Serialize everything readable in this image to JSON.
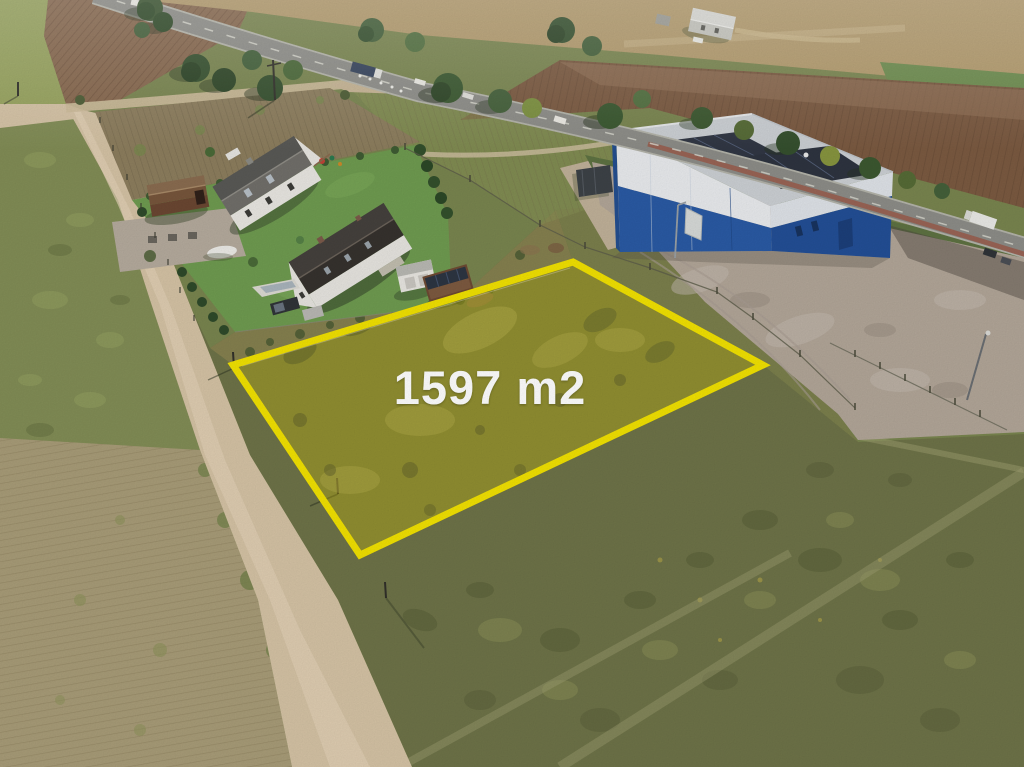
{
  "plot": {
    "area_label": "1597 m2",
    "outline_color": "#f2e202",
    "fill_tint": "#d9c702",
    "label_color": "#ffffff"
  },
  "scene": {
    "type": "aerial-drone-photo",
    "features": [
      "grass building plot outlined in yellow",
      "two white houses with gardens, garage and sheds",
      "blue industrial warehouse with rooftop solar panels and gravel yard",
      "asphalt road with passing cars and trucks",
      "dirt road, plowed fields and stubble field"
    ]
  }
}
